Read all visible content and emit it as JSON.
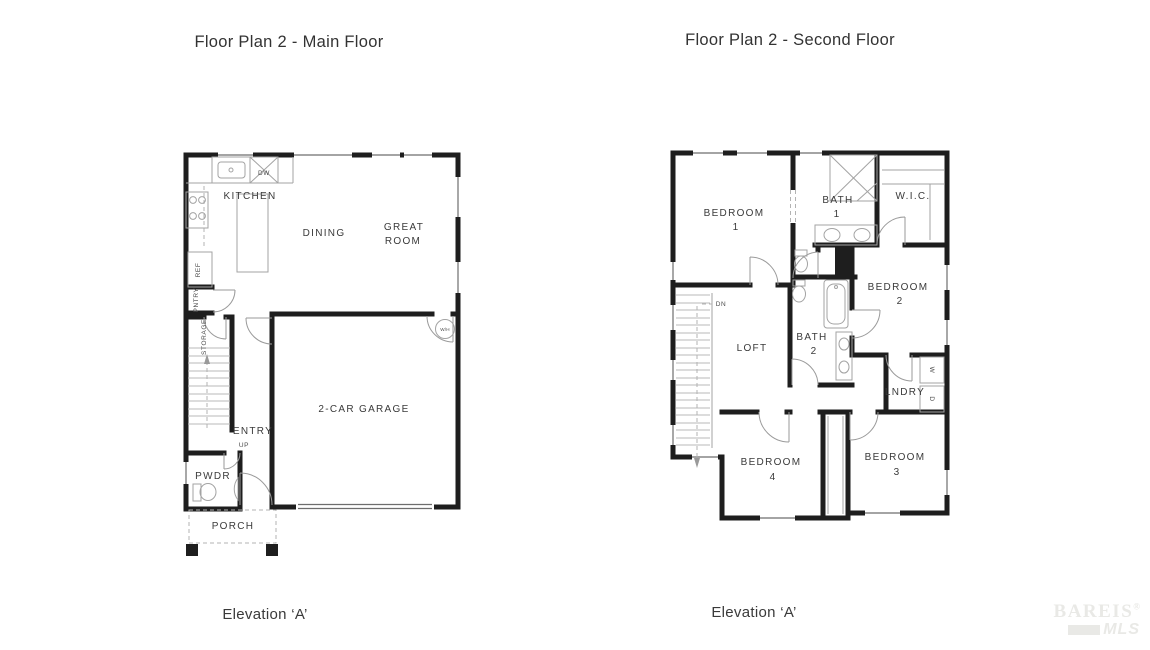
{
  "colors": {
    "background": "#ffffff",
    "wall": "#1e1e1e",
    "fixture": "#a3a3a3",
    "label": "#3a3a3a",
    "watermark": "#e9e9e6"
  },
  "main_floor": {
    "title": "Floor Plan 2 - Main Floor",
    "elevation": "Elevation ‘A’",
    "rooms": {
      "kitchen": {
        "label": "KITCHEN"
      },
      "dining": {
        "label": "DINING"
      },
      "great_room": {
        "line1": "GREAT",
        "line2": "ROOM"
      },
      "garage": {
        "label": "2-CAR GARAGE"
      },
      "entry": {
        "label": "ENTRY"
      },
      "pwdr": {
        "label": "PWDR"
      },
      "porch": {
        "label": "PORCH"
      }
    },
    "annotations": {
      "ref": "REF",
      "pntry": "PNTRY",
      "storage": "STORAGE",
      "dw": "DW",
      "water_heater": "W/H",
      "up": "UP"
    }
  },
  "second_floor": {
    "title": "Floor Plan 2 - Second Floor",
    "elevation": "Elevation ‘A’",
    "rooms": {
      "bedroom1": {
        "line1": "BEDROOM",
        "line2": "1"
      },
      "bath1": {
        "line1": "BATH",
        "line2": "1"
      },
      "wic": {
        "label": "W.I.C."
      },
      "bedroom2": {
        "line1": "BEDROOM",
        "line2": "2"
      },
      "loft": {
        "label": "LOFT"
      },
      "bath2": {
        "line1": "BATH",
        "line2": "2"
      },
      "lndry": {
        "label": "LNDRY"
      },
      "bedroom4": {
        "line1": "BEDROOM",
        "line2": "4"
      },
      "bedroom3": {
        "line1": "BEDROOM",
        "line2": "3"
      }
    },
    "annotations": {
      "dn": "DN",
      "washer": "W",
      "dryer": "D"
    }
  },
  "watermark": {
    "brand_top": "BAREIS",
    "registered": "®",
    "brand_bottom": "MLS"
  }
}
